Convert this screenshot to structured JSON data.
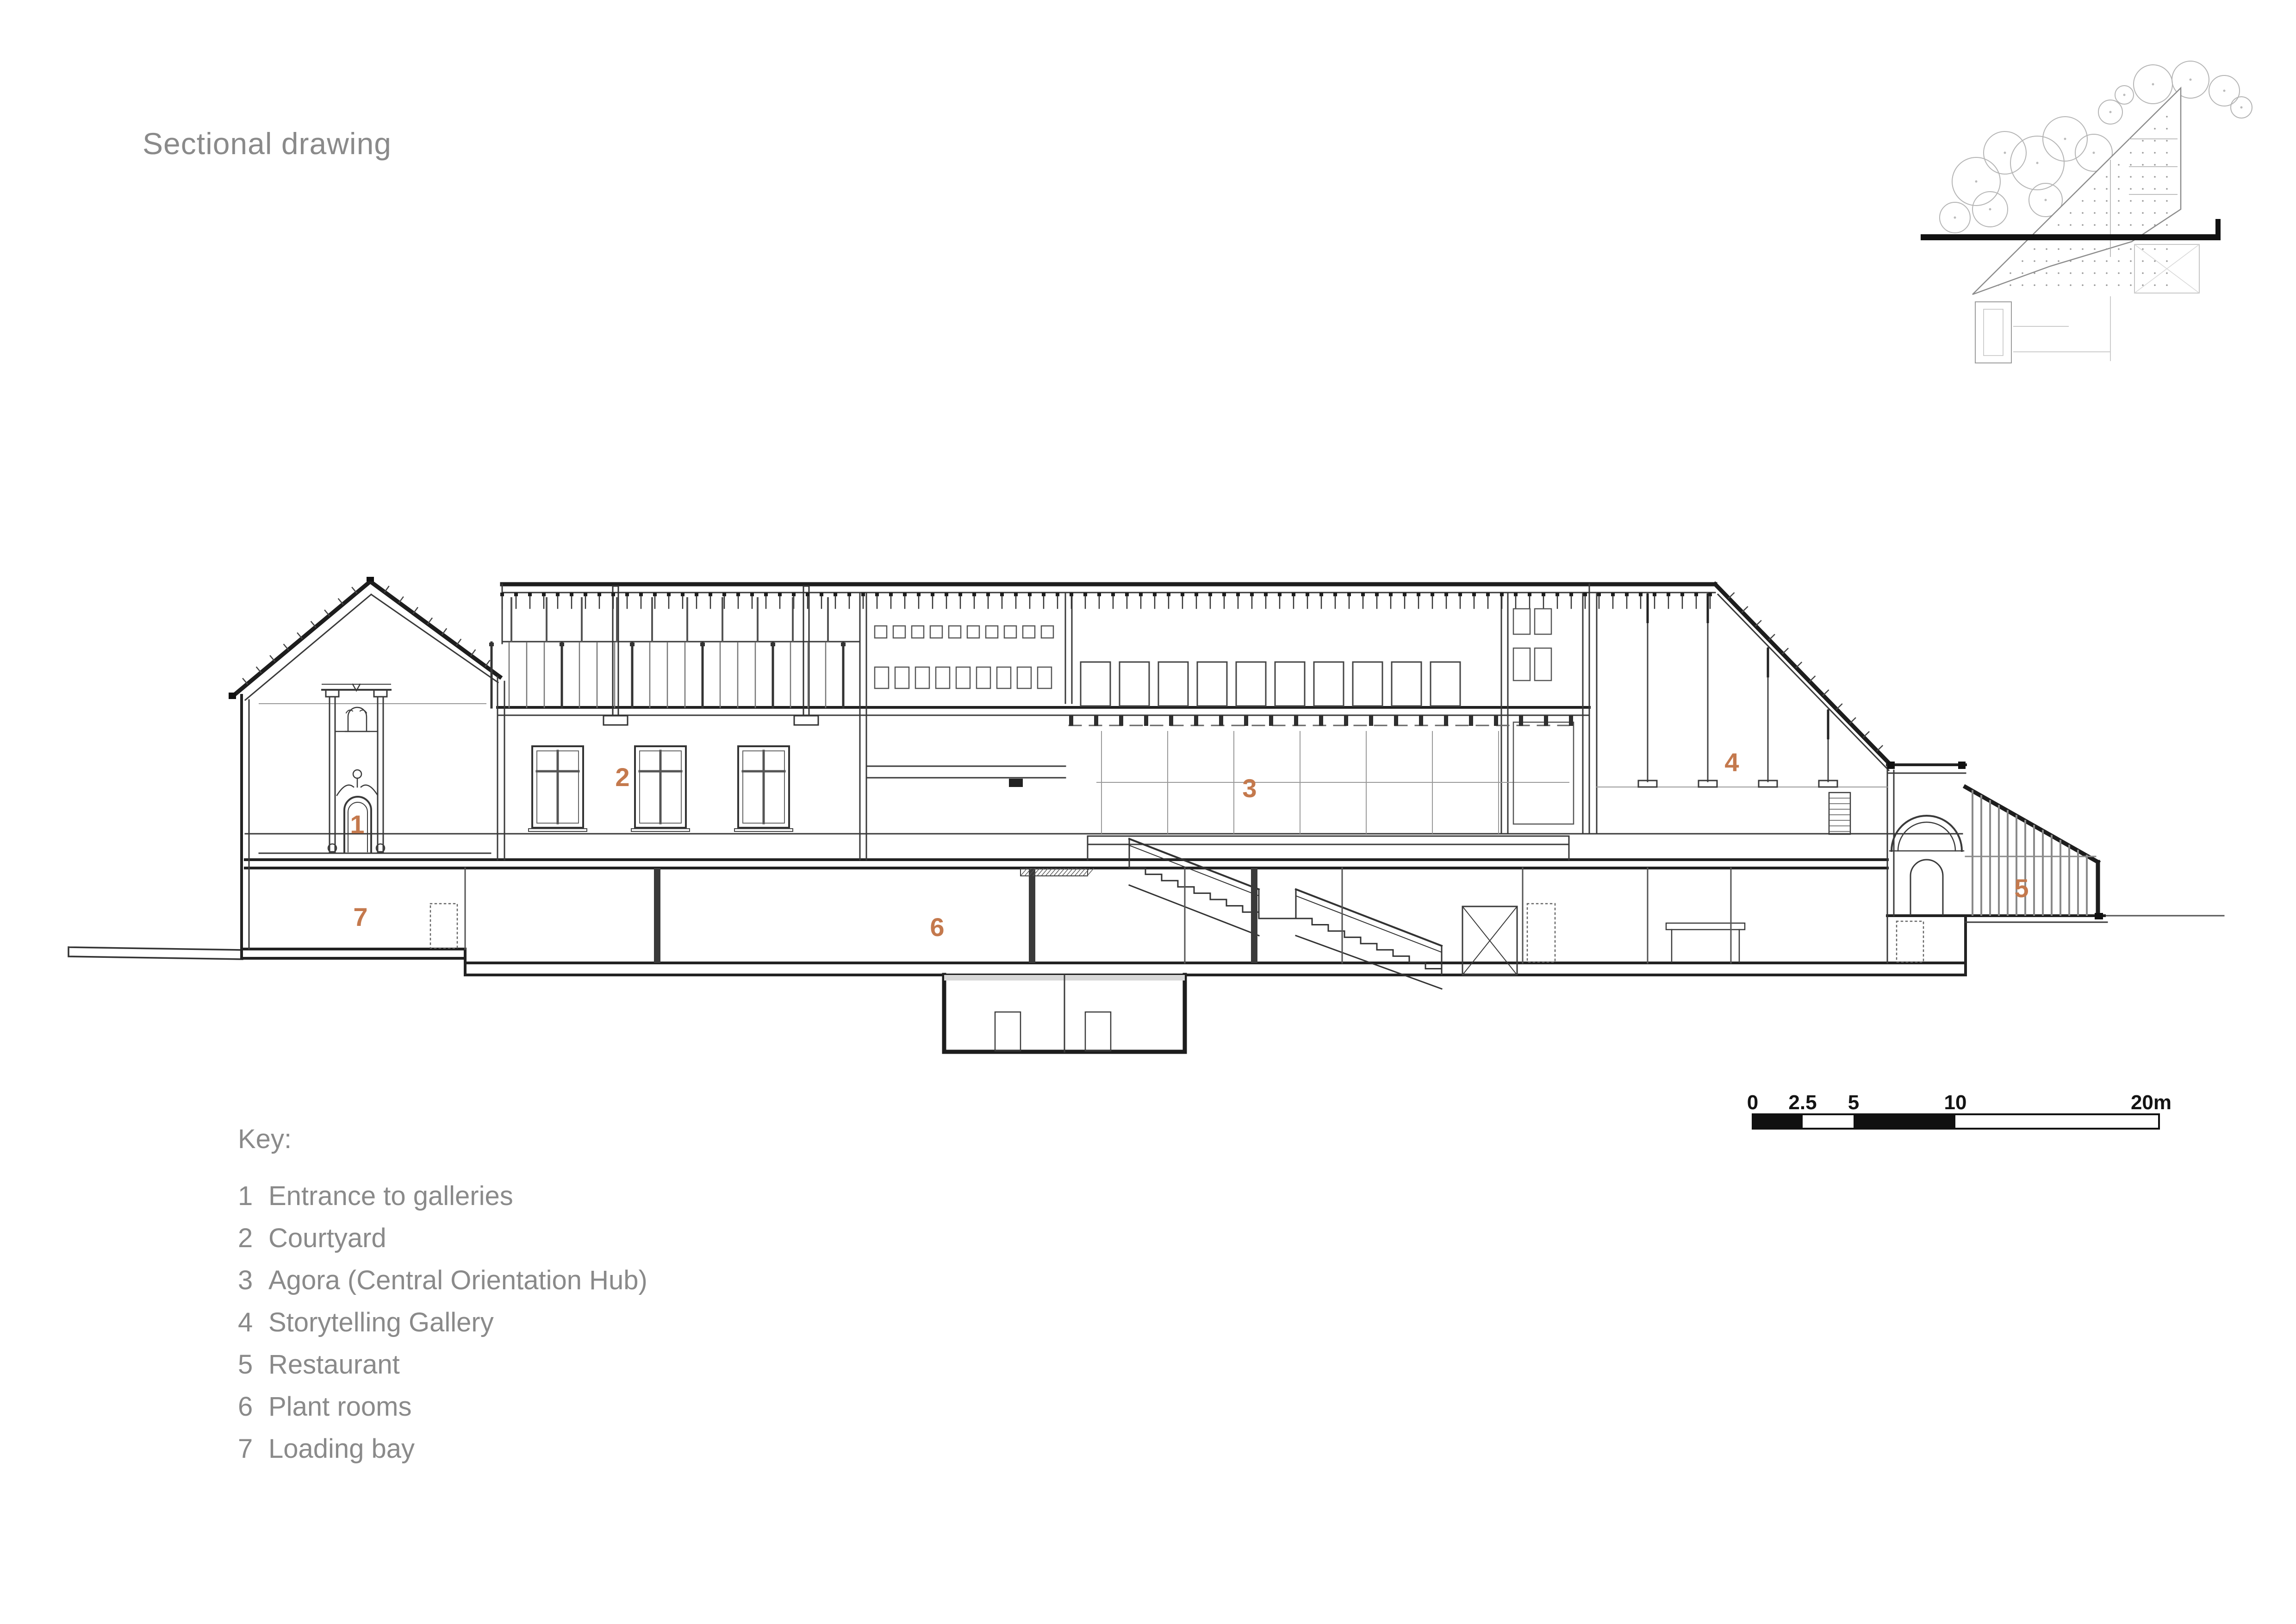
{
  "page": {
    "title": "Sectional drawing"
  },
  "colors": {
    "accent": "#c4794d",
    "text_gray": "#8a8a8a",
    "ink": "#2b2b2b"
  },
  "key": {
    "heading": "Key:",
    "items": [
      {
        "number": "1",
        "label": "Entrance to galleries"
      },
      {
        "number": "2",
        "label": "Courtyard"
      },
      {
        "number": "3",
        "label": "Agora (Central Orientation Hub)"
      },
      {
        "number": "4",
        "label": "Storytelling Gallery"
      },
      {
        "number": "5",
        "label": "Restaurant"
      },
      {
        "number": "6",
        "label": "Plant rooms"
      },
      {
        "number": "7",
        "label": "Loading bay"
      }
    ]
  },
  "section_labels": [
    "1",
    "2",
    "3",
    "4",
    "5",
    "6",
    "7"
  ],
  "scale_bar": {
    "unit": "m",
    "ticks": [
      "0",
      "2.5",
      "5",
      "10",
      "20m"
    ],
    "tick_values": [
      0,
      2.5,
      5,
      10,
      20
    ]
  }
}
